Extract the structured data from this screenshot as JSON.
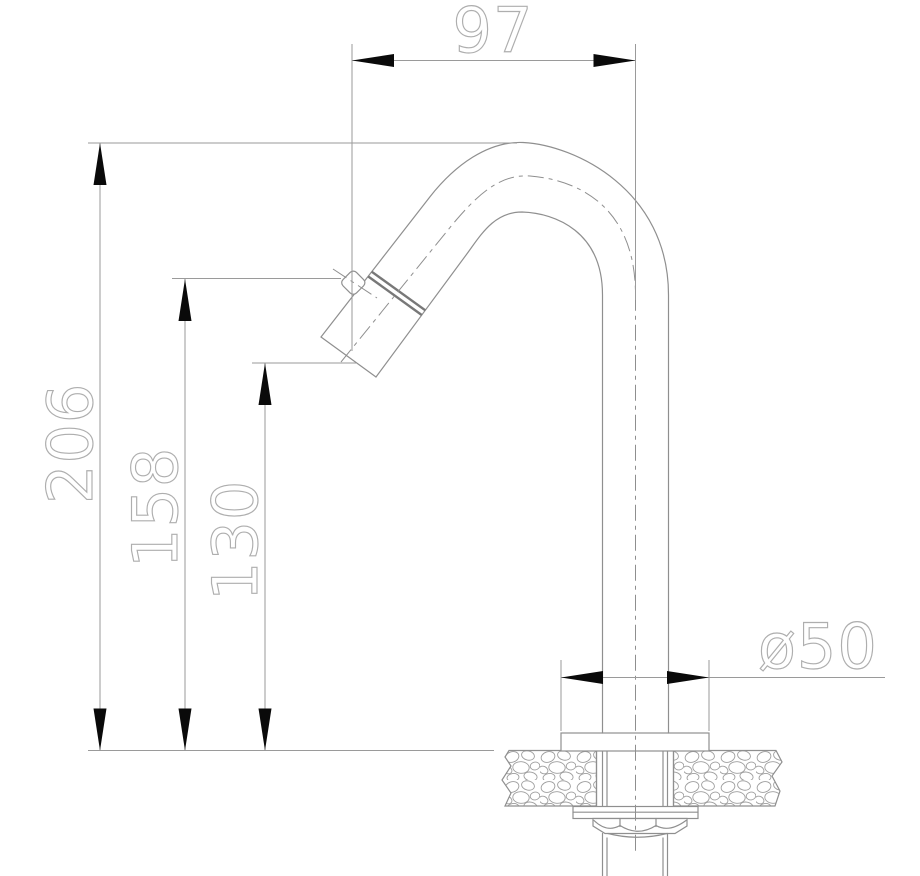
{
  "drawing": {
    "kind": "faucet-installation-technical-drawing",
    "view": "side section with mounting detail"
  },
  "dimensions": {
    "reach": "97",
    "total_height": "206",
    "knob_height": "158",
    "outlet_height": "130",
    "base_diameter": "ø50"
  },
  "colors": {
    "background": "#ffffff",
    "drawing_line": "#8f8f8f",
    "dimension_line": "#9a9a9a",
    "dimension_text": "#aeaeae",
    "arrowhead": "#0a0a0a"
  }
}
